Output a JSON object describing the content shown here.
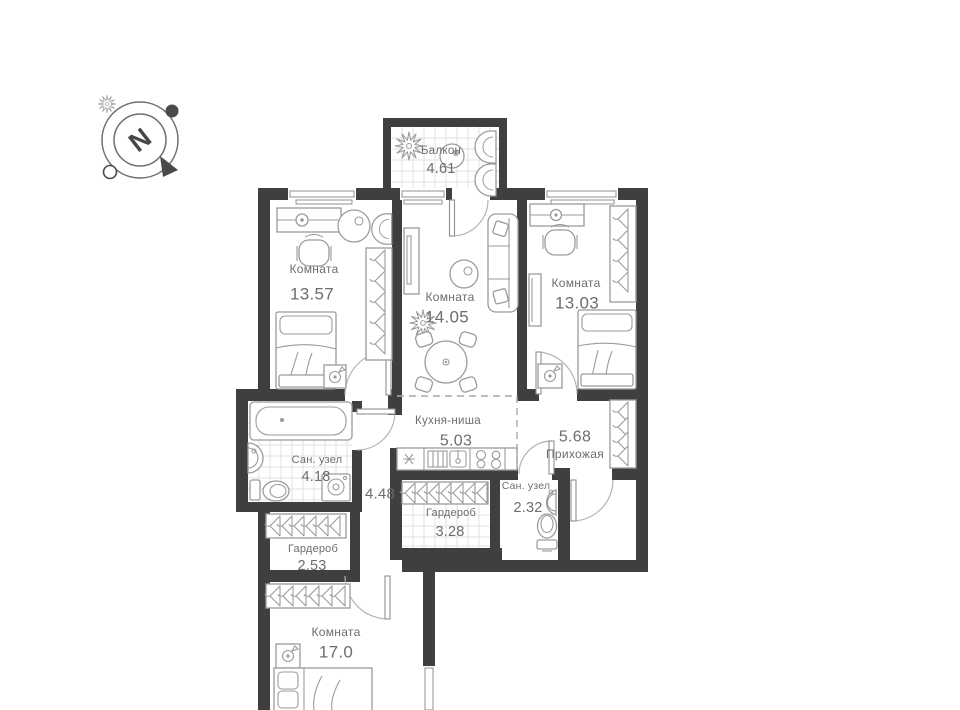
{
  "compass": {
    "north_label": "N"
  },
  "rooms": {
    "balcony": {
      "name": "Балкон",
      "area": "4.61"
    },
    "bedroom1": {
      "name": "Комната",
      "area": "13.57"
    },
    "living": {
      "name": "Комната",
      "area": "14.05"
    },
    "bedroom2": {
      "name": "Комната",
      "area": "13.03"
    },
    "kitchen": {
      "name": "Кухня-ниша",
      "area": "5.03"
    },
    "bathroom1": {
      "name": "Сан. узел",
      "area": "4.18"
    },
    "hallway": {
      "name": "Прихожая",
      "area": "5.68"
    },
    "corridor": {
      "area": "4.48"
    },
    "wardrobe1": {
      "name": "Гардероб",
      "area": "3.28"
    },
    "bathroom2": {
      "name": "Сан. узел",
      "area": "2.32"
    },
    "wardrobe2": {
      "name": "Гардероб",
      "area": "2.53"
    },
    "bedroom3": {
      "name": "Комната",
      "area": "17.0"
    }
  },
  "colors": {
    "wall": "#3f3f3f",
    "furniture_stroke": "#9b9b9b",
    "label_text": "#6d6d6d",
    "tile_line": "#e2e2e2",
    "background": "#ffffff"
  }
}
